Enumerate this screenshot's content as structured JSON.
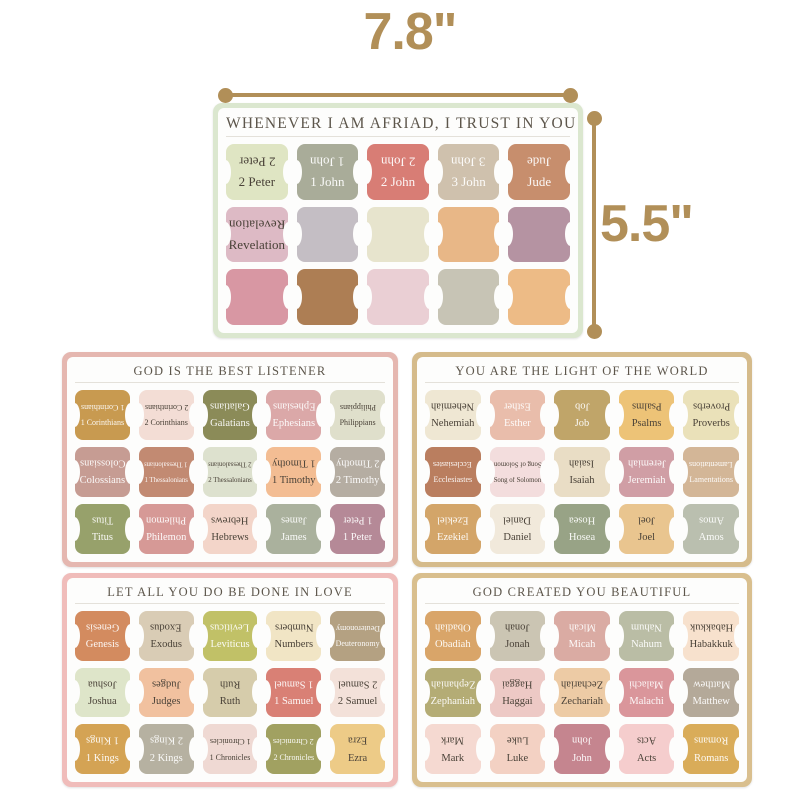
{
  "annotations": {
    "width_label": "7.8\"",
    "height_label": "5.5\"",
    "accent_color": "#b18f58"
  },
  "sheets": [
    {
      "title": "WHENEVER I AM AFRIAD, I TRUST IN YOU",
      "border_color": "#dbe7cf",
      "tabs": [
        {
          "label": "2 Peter",
          "color": "#dfe5c3",
          "tone": "dark"
        },
        {
          "label": "1 John",
          "color": "#a9ac99",
          "tone": "light"
        },
        {
          "label": "2 John",
          "color": "#d87d75",
          "tone": "light"
        },
        {
          "label": "3 John",
          "color": "#cfc1ad",
          "tone": "light"
        },
        {
          "label": "Jude",
          "color": "#c78e6d",
          "tone": "light"
        },
        {
          "label": "Revelation",
          "color": "#ddbac5",
          "tone": "dark"
        },
        {
          "label": "",
          "color": "#c4bec4",
          "tone": "dark"
        },
        {
          "label": "",
          "color": "#e7e4cd",
          "tone": "dark"
        },
        {
          "label": "",
          "color": "#e8b787",
          "tone": "dark"
        },
        {
          "label": "",
          "color": "#b593a2",
          "tone": "dark"
        },
        {
          "label": "",
          "color": "#d897a3",
          "tone": "dark"
        },
        {
          "label": "",
          "color": "#ad7e54",
          "tone": "dark"
        },
        {
          "label": "",
          "color": "#eacfd4",
          "tone": "dark"
        },
        {
          "label": "",
          "color": "#c7c4b5",
          "tone": "dark"
        },
        {
          "label": "",
          "color": "#edbb86",
          "tone": "dark"
        }
      ]
    },
    {
      "title": "GOD IS THE BEST LISTENER",
      "border_color": "#e5b7b0",
      "tabs": [
        {
          "label": "1 Corinthians",
          "color": "#c89a50",
          "tone": "light"
        },
        {
          "label": "2 Corinthians",
          "color": "#f3ddd5",
          "tone": "dark"
        },
        {
          "label": "Galatians",
          "color": "#8b8b58",
          "tone": "light"
        },
        {
          "label": "Ephesians",
          "color": "#dba8a8",
          "tone": "light"
        },
        {
          "label": "Philippians",
          "color": "#dfdfcb",
          "tone": "dark"
        },
        {
          "label": "Colossians",
          "color": "#c69c93",
          "tone": "light"
        },
        {
          "label": "1 Thessalonians",
          "color": "#c28a72",
          "tone": "light"
        },
        {
          "label": "2 Thessalonians",
          "color": "#dde1ce",
          "tone": "dark"
        },
        {
          "label": "1 Timothy",
          "color": "#f3bd93",
          "tone": "dark"
        },
        {
          "label": "2 Timothy",
          "color": "#b5ada2",
          "tone": "light"
        },
        {
          "label": "Titus",
          "color": "#97a16b",
          "tone": "light"
        },
        {
          "label": "Philemon",
          "color": "#d69996",
          "tone": "light"
        },
        {
          "label": "Hebrews",
          "color": "#f3d5c9",
          "tone": "dark"
        },
        {
          "label": "James",
          "color": "#aab19d",
          "tone": "light"
        },
        {
          "label": "1 Peter",
          "color": "#b58997",
          "tone": "light"
        }
      ]
    },
    {
      "title": "YOU ARE THE LIGHT OF THE WORLD",
      "border_color": "#d5bb8b",
      "tabs": [
        {
          "label": "Nehemiah",
          "color": "#efe7d3",
          "tone": "dark"
        },
        {
          "label": "Esther",
          "color": "#e9bdab",
          "tone": "light"
        },
        {
          "label": "Job",
          "color": "#c0a569",
          "tone": "light"
        },
        {
          "label": "Psalms",
          "color": "#edc377",
          "tone": "dark"
        },
        {
          "label": "Proverbs",
          "color": "#eae1b9",
          "tone": "dark"
        },
        {
          "label": "Ecclesiastes",
          "color": "#ba7e5f",
          "tone": "light"
        },
        {
          "label": "Song of Solomon",
          "color": "#f3dddd",
          "tone": "dark"
        },
        {
          "label": "Isaiah",
          "color": "#e9ddc5",
          "tone": "dark"
        },
        {
          "label": "Jeremiah",
          "color": "#d09ea5",
          "tone": "light"
        },
        {
          "label": "Lamentations",
          "color": "#d3b697",
          "tone": "light"
        },
        {
          "label": "Ezekiel",
          "color": "#d3a569",
          "tone": "light"
        },
        {
          "label": "Daniel",
          "color": "#f1e9db",
          "tone": "dark"
        },
        {
          "label": "Hosea",
          "color": "#98a386",
          "tone": "light"
        },
        {
          "label": "Joel",
          "color": "#e9c58f",
          "tone": "dark"
        },
        {
          "label": "Amos",
          "color": "#babfaf",
          "tone": "light"
        }
      ]
    },
    {
      "title": "LET ALL YOU DO BE DONE IN LOVE",
      "border_color": "#f0bcba",
      "tabs": [
        {
          "label": "Genesis",
          "color": "#d38b5f",
          "tone": "light"
        },
        {
          "label": "Exodus",
          "color": "#d9ccb5",
          "tone": "dark"
        },
        {
          "label": "Leviticus",
          "color": "#c1c167",
          "tone": "light"
        },
        {
          "label": "Numbers",
          "color": "#f1e5c5",
          "tone": "dark"
        },
        {
          "label": "Deuteronomy",
          "color": "#b4a182",
          "tone": "light"
        },
        {
          "label": "Joshua",
          "color": "#dee5c9",
          "tone": "dark"
        },
        {
          "label": "Judges",
          "color": "#f1c19f",
          "tone": "dark"
        },
        {
          "label": "Ruth",
          "color": "#d6ccab",
          "tone": "dark"
        },
        {
          "label": "1 Samuel",
          "color": "#d98075",
          "tone": "light"
        },
        {
          "label": "2 Samuel",
          "color": "#f3e1d9",
          "tone": "dark"
        },
        {
          "label": "1 Kings",
          "color": "#d4a354",
          "tone": "light"
        },
        {
          "label": "2 Kings",
          "color": "#b6b1a1",
          "tone": "light"
        },
        {
          "label": "1 Chronicles",
          "color": "#efd9d3",
          "tone": "dark"
        },
        {
          "label": "2 Chronicles",
          "color": "#a1a161",
          "tone": "light"
        },
        {
          "label": "Ezra",
          "color": "#edcb87",
          "tone": "dark"
        }
      ]
    },
    {
      "title": "GOD CREATED YOU BEAUTIFUL",
      "border_color": "#d9bf8e",
      "tabs": [
        {
          "label": "Obadiah",
          "color": "#d9a569",
          "tone": "light"
        },
        {
          "label": "Jonah",
          "color": "#cbc5b3",
          "tone": "dark"
        },
        {
          "label": "Micah",
          "color": "#daaba3",
          "tone": "light"
        },
        {
          "label": "Nahum",
          "color": "#babda5",
          "tone": "light"
        },
        {
          "label": "Habakkuk",
          "color": "#f7e1cd",
          "tone": "dark"
        },
        {
          "label": "Zephaniah",
          "color": "#b4ac75",
          "tone": "light"
        },
        {
          "label": "Haggai",
          "color": "#edc9c5",
          "tone": "dark"
        },
        {
          "label": "Zechariah",
          "color": "#edcba5",
          "tone": "dark"
        },
        {
          "label": "Malachi",
          "color": "#da969b",
          "tone": "light"
        },
        {
          "label": "Matthew",
          "color": "#b4a999",
          "tone": "light"
        },
        {
          "label": "Mark",
          "color": "#f5d9d1",
          "tone": "dark"
        },
        {
          "label": "Luke",
          "color": "#f3d1c3",
          "tone": "dark"
        },
        {
          "label": "John",
          "color": "#c5858f",
          "tone": "light"
        },
        {
          "label": "Acts",
          "color": "#f5cdcd",
          "tone": "dark"
        },
        {
          "label": "Romans",
          "color": "#d9ac59",
          "tone": "light"
        }
      ]
    }
  ]
}
